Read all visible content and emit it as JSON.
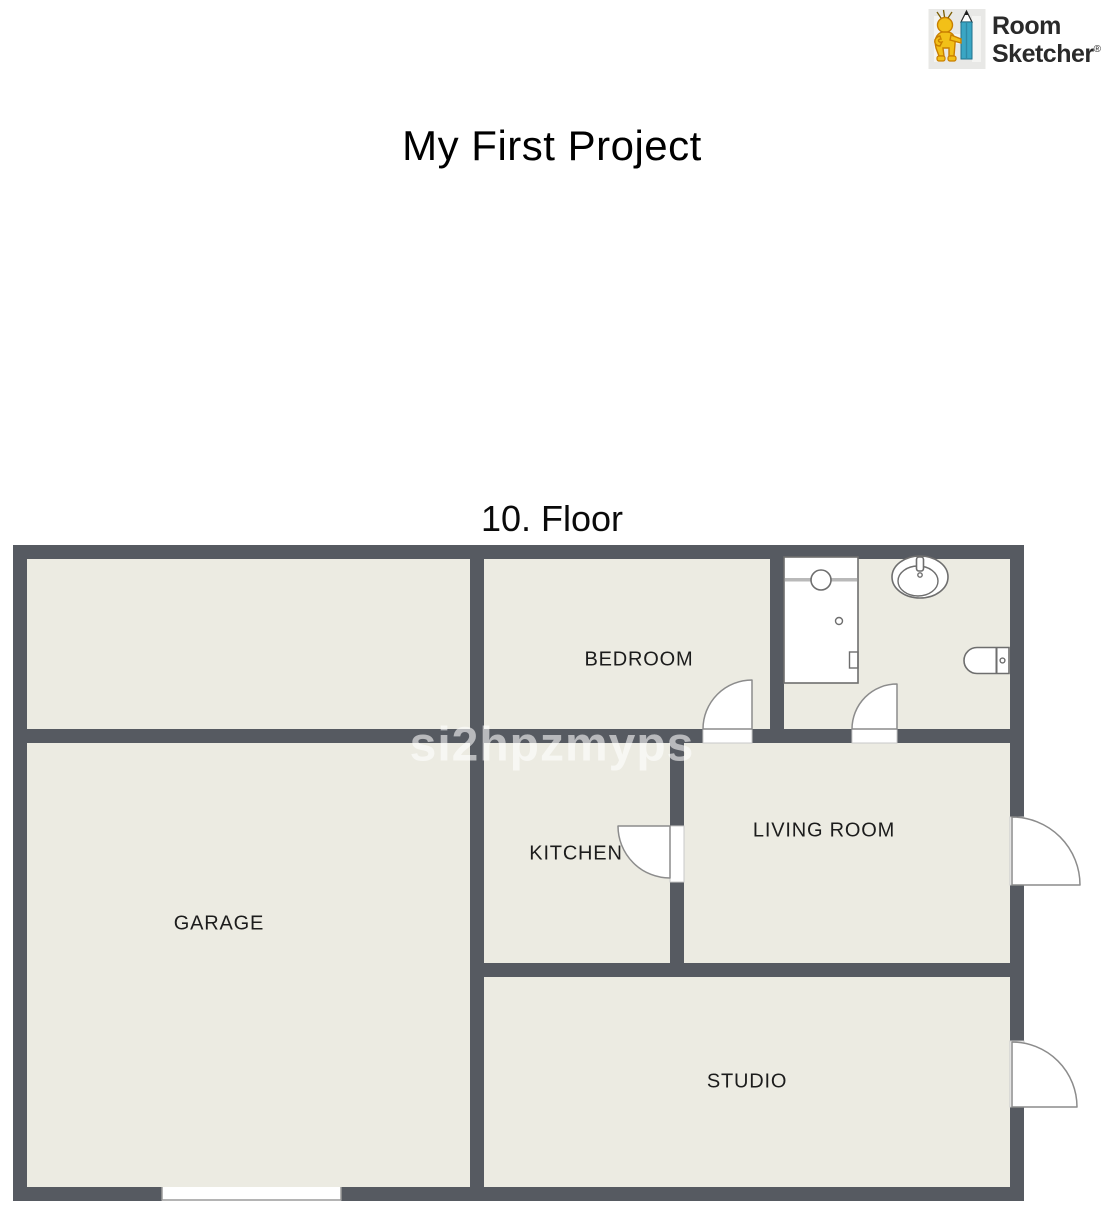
{
  "brand": {
    "name_line1": "Room",
    "name_line2": "Sketcher",
    "registered": "®",
    "icon": "mascot-with-pencil-icon"
  },
  "project_title": "My First Project",
  "floor": {
    "label": "10. Floor"
  },
  "watermark": "si2hpzmyps",
  "rooms": {
    "bedroom": "BEDROOM",
    "kitchen": "KITCHEN",
    "living_room": "LIVING ROOM",
    "garage": "GARAGE",
    "studio": "STUDIO"
  },
  "fixtures": [
    "shower-icon",
    "sink-icon",
    "toilet-icon"
  ],
  "doors": {
    "interior_swing_doors": [
      "bedroom-door",
      "bathroom-door",
      "kitchen-door"
    ],
    "exterior_swing_doors": [
      "living-room-entry-door",
      "studio-entry-door"
    ],
    "garage_opening": "garage-door-opening"
  },
  "colors": {
    "wall": "#565a61",
    "floor": "#ecebe2",
    "background": "#ffffff",
    "label": "#1c1c1c",
    "pencil_teal": "#3aa6c4",
    "mascot_yellow": "#f2c018",
    "watermark": "rgba(255,255,255,0.58)"
  }
}
